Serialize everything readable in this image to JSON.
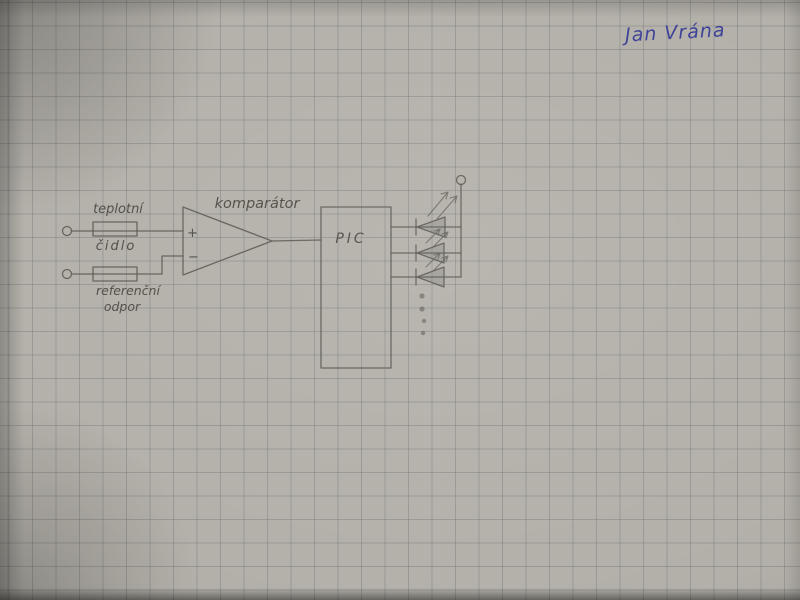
{
  "signature": {
    "text": "Jan Vrána",
    "color": "#3a3f96"
  },
  "diagram": {
    "paper_color": "#b3b0a9",
    "grid_color": "#8f9094",
    "pencil_color": "#55524b",
    "labels": {
      "sensor_line1": "teplotní",
      "sensor_line2": "čidlo",
      "reference_line1": "referenční",
      "reference_line2": "odpor",
      "comparator": "komparátor",
      "mcu": "PIC",
      "plus": "+",
      "minus": "−"
    },
    "leds": {
      "count": 3,
      "more_outputs_dots": 4
    }
  }
}
